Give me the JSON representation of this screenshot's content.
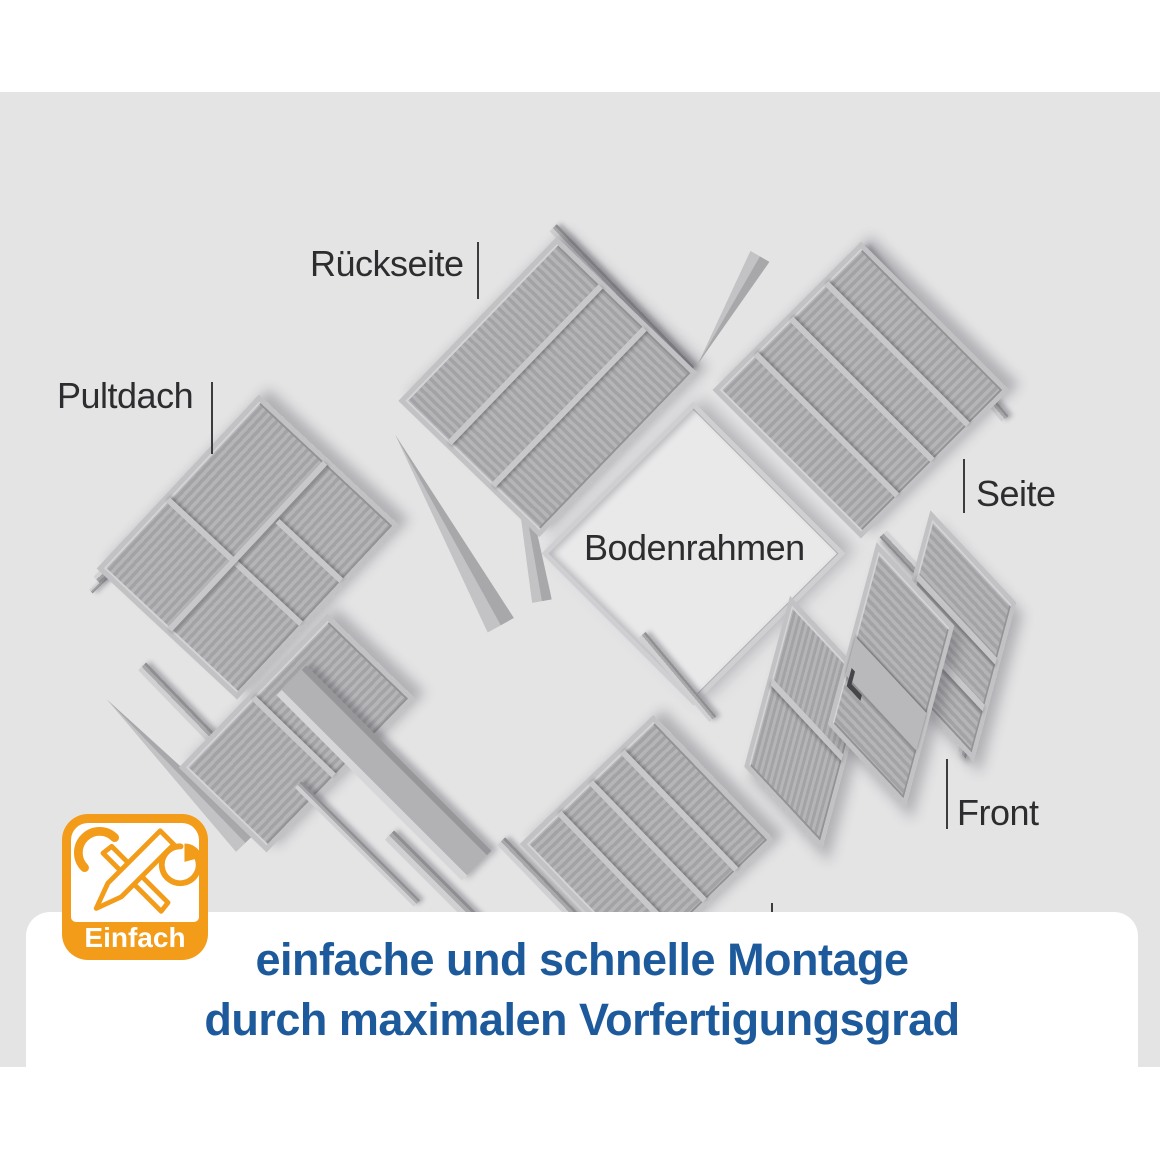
{
  "diagram": {
    "description": "exploded parts diagram of a pent-roof garden shed",
    "part_labels": {
      "rueckseite": "Rückseite",
      "pultdach": "Pultdach",
      "seite_top": "Seite",
      "bodenrahmen": "Bodenrahmen",
      "front": "Front",
      "seite_bottom": "Seite"
    }
  },
  "badge": {
    "label": "Einfach",
    "accent_color": "#f29c1a",
    "icons": [
      "wrench-icon",
      "pencil-icon",
      "pie-chart-icon"
    ]
  },
  "caption": {
    "line1": "einfache und schnelle Montage",
    "line2": "durch maximalen Vorfertigungsgrad",
    "text_color": "#1d5a9c"
  },
  "colors": {
    "canvas_bg": "#ffffff",
    "stage_bg": "#e4e4e5",
    "panel_face": "#ababad",
    "label_text": "#2d2d2f"
  }
}
